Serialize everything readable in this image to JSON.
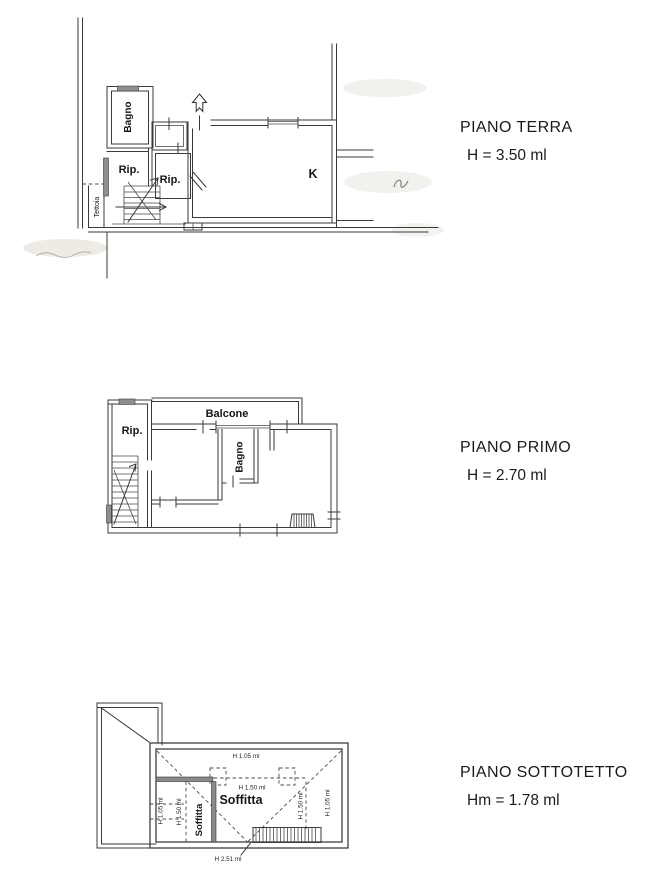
{
  "document": {
    "type": "architectural-floor-plans",
    "background": "#ffffff",
    "ink": "#3a3a3a",
    "window_fill": "#8f8f8f",
    "text_color": "#1b1b1b"
  },
  "floors": [
    {
      "name": "piano-terra",
      "title": "PIANO TERRA",
      "height": "H = 3.50 ml",
      "labels": {
        "bagno": "Bagno",
        "rip1": "Rip.",
        "rip2": "Rip.",
        "kitchen": "K",
        "tettoia": "Tettoia"
      }
    },
    {
      "name": "piano-primo",
      "title": "PIANO PRIMO",
      "height": "H = 2.70 ml",
      "labels": {
        "balcone": "Balcone",
        "rip": "Rip.",
        "bagno": "Bagno"
      }
    },
    {
      "name": "piano-sottotetto",
      "title": "PIANO SOTTOTETTO",
      "height": "Hm = 1.78 ml",
      "labels": {
        "soffitta_main": "Soffitta",
        "soffitta_left": "Soffitta"
      },
      "dims": {
        "top": "H 1.05 ml",
        "center": "H 1.50 ml",
        "left_outer": "H 1.05 ml",
        "left_inner": "H 1.50 ml",
        "right_inner": "H 1.50 ml",
        "right_outer": "H 1.05 ml",
        "ridge": "H 2.51 ml"
      }
    }
  ]
}
